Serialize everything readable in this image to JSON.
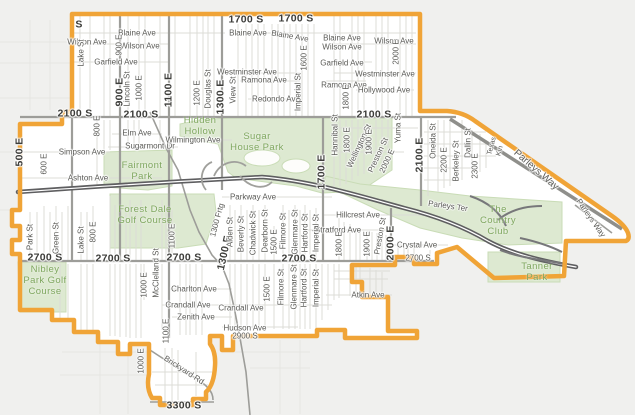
{
  "map": {
    "colors": {
      "boundary": "#f0a437",
      "bg_outside": "#f0f0ee",
      "bg_inside": "#ffffff",
      "park_fill": "#dde9d1",
      "park_stroke": "#c9dcb6",
      "park_text": "#7fa75f",
      "highway": "#5e5e60",
      "road_major": "#9d9d99",
      "road_minor": "#dcdcd7",
      "road_faint": "#e6e6e2",
      "label": "#5a5a56",
      "label_bold": "#3c3c39"
    },
    "street_labels": [
      {
        "t": "1700 S",
        "x": 246,
        "y": 20,
        "b": true
      },
      {
        "t": "1700 S",
        "x": 296,
        "y": 19,
        "b": true
      },
      {
        "t": "2100 S",
        "x": 75,
        "y": 114,
        "b": true
      },
      {
        "t": "2100 S",
        "x": 141,
        "y": 115,
        "b": true
      },
      {
        "t": "2100 S",
        "x": 374,
        "y": 115,
        "b": true
      },
      {
        "t": "2700 S",
        "x": 45,
        "y": 258,
        "b": true
      },
      {
        "t": "2700 S",
        "x": 113,
        "y": 259,
        "b": true
      },
      {
        "t": "2700 S",
        "x": 184,
        "y": 258,
        "b": true
      },
      {
        "t": "2700 S",
        "x": 299,
        "y": 259,
        "b": true
      },
      {
        "t": "3300 S",
        "x": 184,
        "y": 406,
        "b": true
      },
      {
        "t": "S",
        "x": 79,
        "y": 25,
        "b": true
      },
      {
        "t": "500 E",
        "x": 20,
        "y": 152,
        "r": -90,
        "b": true
      },
      {
        "t": "900 E",
        "x": 120,
        "y": 92,
        "r": -90,
        "b": true
      },
      {
        "t": "1100 E",
        "x": 169,
        "y": 90,
        "r": -90,
        "b": true
      },
      {
        "t": "1300 E",
        "x": 221,
        "y": 97,
        "r": -90,
        "b": true
      },
      {
        "t": "1700 E",
        "x": 322,
        "y": 172,
        "r": -90,
        "b": true
      },
      {
        "t": "2100 E",
        "x": 420,
        "y": 155,
        "r": -90,
        "b": true
      },
      {
        "t": "2000 E",
        "x": 391,
        "y": 243,
        "r": -90,
        "b": true
      },
      {
        "t": "1300 E",
        "x": 225,
        "y": 253,
        "r": -78,
        "b": true
      },
      {
        "t": "Wilson Ave",
        "x": 87,
        "y": 42
      },
      {
        "t": "Blaine Ave",
        "x": 137,
        "y": 33
      },
      {
        "t": "Wilson Ave",
        "x": 140,
        "y": 46
      },
      {
        "t": "Garfield Ave",
        "x": 116,
        "y": 62
      },
      {
        "t": "Blaine Ave",
        "x": 248,
        "y": 33
      },
      {
        "t": "Blaine Ave",
        "x": 290,
        "y": 36,
        "r": 10
      },
      {
        "t": "Blaine Ave",
        "x": 342,
        "y": 38
      },
      {
        "t": "Wilson Ave",
        "x": 342,
        "y": 47
      },
      {
        "t": "Wilson Ave",
        "x": 394,
        "y": 41
      },
      {
        "t": "Garfield Ave",
        "x": 342,
        "y": 63
      },
      {
        "t": "Westminster Ave",
        "x": 247,
        "y": 72
      },
      {
        "t": "Westminster Ave",
        "x": 385,
        "y": 74
      },
      {
        "t": "Ramona Ave",
        "x": 264,
        "y": 80
      },
      {
        "t": "Ramona Ave",
        "x": 344,
        "y": 85
      },
      {
        "t": "Hollywood Ave",
        "x": 384,
        "y": 90
      },
      {
        "t": "Redondo Ave",
        "x": 276,
        "y": 99
      },
      {
        "t": "Simpson Ave",
        "x": 82,
        "y": 152
      },
      {
        "t": "Elm Ave",
        "x": 137,
        "y": 133
      },
      {
        "t": "Sugarmont Dr",
        "x": 150,
        "y": 146
      },
      {
        "t": "Wilmington Ave",
        "x": 193,
        "y": 140
      },
      {
        "t": "Ashton Ave",
        "x": 88,
        "y": 178
      },
      {
        "t": "Parkway Ave",
        "x": 253,
        "y": 197
      },
      {
        "t": "Hillcrest Ave",
        "x": 358,
        "y": 215
      },
      {
        "t": "Stratford Ave",
        "x": 338,
        "y": 230
      },
      {
        "t": "Crystal Ave",
        "x": 417,
        "y": 245
      },
      {
        "t": "Parleys Ter",
        "x": 448,
        "y": 206,
        "r": 8
      },
      {
        "t": "Charlton Ave",
        "x": 194,
        "y": 289
      },
      {
        "t": "Crandall Ave",
        "x": 188,
        "y": 305
      },
      {
        "t": "Crandall Ave",
        "x": 241,
        "y": 308
      },
      {
        "t": "Zenith Ave",
        "x": 196,
        "y": 317
      },
      {
        "t": "Hudson Ave",
        "x": 245,
        "y": 328
      },
      {
        "t": "2900 S",
        "x": 245,
        "y": 336
      },
      {
        "t": "Atkin Ave",
        "x": 368,
        "y": 295
      },
      {
        "t": "2700 S",
        "x": 418,
        "y": 258
      },
      {
        "t": "Brickyard Rd",
        "x": 184,
        "y": 370,
        "r": 33
      },
      {
        "t": "Parleys Way",
        "x": 536,
        "y": 170,
        "r": 41,
        "s": 10
      },
      {
        "t": "Parleys Way",
        "x": 591,
        "y": 218,
        "r": 55
      },
      {
        "t": "Lake St",
        "x": 81,
        "y": 53,
        "r": -90
      },
      {
        "t": "900 E",
        "x": 119,
        "y": 45,
        "r": -90
      },
      {
        "t": "Lincoln St",
        "x": 127,
        "y": 89,
        "r": -90
      },
      {
        "t": "1000 E",
        "x": 139,
        "y": 88,
        "r": -90
      },
      {
        "t": "1200 E",
        "x": 197,
        "y": 93,
        "r": -90
      },
      {
        "t": "Douglas St",
        "x": 208,
        "y": 89,
        "r": -90
      },
      {
        "t": "View St",
        "x": 233,
        "y": 90,
        "r": -90
      },
      {
        "t": "1600 E",
        "x": 304,
        "y": 58,
        "r": -90
      },
      {
        "t": "Imperial St",
        "x": 298,
        "y": 92,
        "r": -90
      },
      {
        "t": "1800 E",
        "x": 346,
        "y": 97,
        "r": -90
      },
      {
        "t": "2000 E",
        "x": 396,
        "y": 52,
        "r": -90
      },
      {
        "t": "Yuma St",
        "x": 398,
        "y": 128,
        "r": -90
      },
      {
        "t": "Oneida St",
        "x": 433,
        "y": 141,
        "r": -90
      },
      {
        "t": "2200 E",
        "x": 444,
        "y": 160,
        "r": -90
      },
      {
        "t": "Berkeley St",
        "x": 456,
        "y": 161,
        "r": -90
      },
      {
        "t": "Dallin St",
        "x": 468,
        "y": 143,
        "r": -90
      },
      {
        "t": "2300 E",
        "x": 475,
        "y": 166,
        "r": -90
      },
      {
        "t": "Texas",
        "x": 492,
        "y": 146,
        "r": -75,
        "s": 7
      },
      {
        "t": "Kin",
        "x": 500,
        "y": 151,
        "r": -75,
        "s": 7
      },
      {
        "t": "Hannibal St",
        "x": 335,
        "y": 135,
        "r": -90
      },
      {
        "t": "1800 E",
        "x": 347,
        "y": 140,
        "r": -90
      },
      {
        "t": "Wellington St",
        "x": 359,
        "y": 146,
        "r": -65
      },
      {
        "t": "1900 E",
        "x": 369,
        "y": 142,
        "r": -90
      },
      {
        "t": "Preston St",
        "x": 378,
        "y": 155,
        "r": -65
      },
      {
        "t": "2000 E",
        "x": 387,
        "y": 161,
        "r": -65
      },
      {
        "t": "1800 E",
        "x": 339,
        "y": 244,
        "r": -90
      },
      {
        "t": "1900 E",
        "x": 367,
        "y": 244,
        "r": -90
      },
      {
        "t": "Preston St",
        "x": 380,
        "y": 236,
        "r": -80
      },
      {
        "t": "1300 Frtg",
        "x": 217,
        "y": 220,
        "r": -75
      },
      {
        "t": "Alden St",
        "x": 230,
        "y": 232,
        "r": -90
      },
      {
        "t": "Beverly St",
        "x": 241,
        "y": 234,
        "r": -90
      },
      {
        "t": "Chadwick St",
        "x": 253,
        "y": 233,
        "r": -90
      },
      {
        "t": "Dearborn St",
        "x": 265,
        "y": 231,
        "r": -90
      },
      {
        "t": "1500 E",
        "x": 274,
        "y": 242,
        "r": -90
      },
      {
        "t": "Filmore St",
        "x": 283,
        "y": 231,
        "r": -90
      },
      {
        "t": "Glenmare St",
        "x": 295,
        "y": 232,
        "r": -90
      },
      {
        "t": "Hartford St",
        "x": 305,
        "y": 233,
        "r": -90
      },
      {
        "t": "Imperial St",
        "x": 316,
        "y": 233,
        "r": -90
      },
      {
        "t": "1500 E",
        "x": 267,
        "y": 289,
        "r": -90
      },
      {
        "t": "Filmore St",
        "x": 281,
        "y": 287,
        "r": -90
      },
      {
        "t": "Glenmare St",
        "x": 294,
        "y": 287,
        "r": -90
      },
      {
        "t": "Hartford St",
        "x": 304,
        "y": 288,
        "r": -90
      },
      {
        "t": "Imperial St",
        "x": 316,
        "y": 288,
        "r": -90
      },
      {
        "t": "McClelland St",
        "x": 156,
        "y": 273,
        "r": -90
      },
      {
        "t": "1000 E",
        "x": 144,
        "y": 285,
        "r": -90
      },
      {
        "t": "1100 E",
        "x": 172,
        "y": 236,
        "r": -90
      },
      {
        "t": "1100 E",
        "x": 166,
        "y": 331,
        "r": -90
      },
      {
        "t": "1000 E",
        "x": 141,
        "y": 361,
        "r": -90
      },
      {
        "t": "600 E",
        "x": 44,
        "y": 164,
        "r": -90
      },
      {
        "t": "800 E",
        "x": 97,
        "y": 126,
        "r": -90
      },
      {
        "t": "800 E",
        "x": 93,
        "y": 232,
        "r": -90
      },
      {
        "t": "Lake St",
        "x": 81,
        "y": 240,
        "r": -90
      },
      {
        "t": "Park St",
        "x": 30,
        "y": 237,
        "r": -90
      },
      {
        "t": "Green St",
        "x": 56,
        "y": 238,
        "r": -90
      }
    ],
    "park_labels": [
      {
        "lines": [
          "Hidden",
          "Hollow"
        ],
        "x": 200,
        "y": 115
      },
      {
        "lines": [
          "Sugar",
          "House Park"
        ],
        "x": 257,
        "y": 131
      },
      {
        "lines": [
          "Fairmont",
          "Park"
        ],
        "x": 142,
        "y": 160
      },
      {
        "lines": [
          "Forest Dale",
          "Golf Course"
        ],
        "x": 145,
        "y": 204
      },
      {
        "lines": [
          "Nibley",
          "Park Golf",
          "Course"
        ],
        "x": 45,
        "y": 264
      },
      {
        "lines": [
          "The",
          "Country",
          "Club"
        ],
        "x": 498,
        "y": 204
      },
      {
        "lines": [
          "Tanner",
          "Park"
        ],
        "x": 537,
        "y": 261
      }
    ]
  }
}
